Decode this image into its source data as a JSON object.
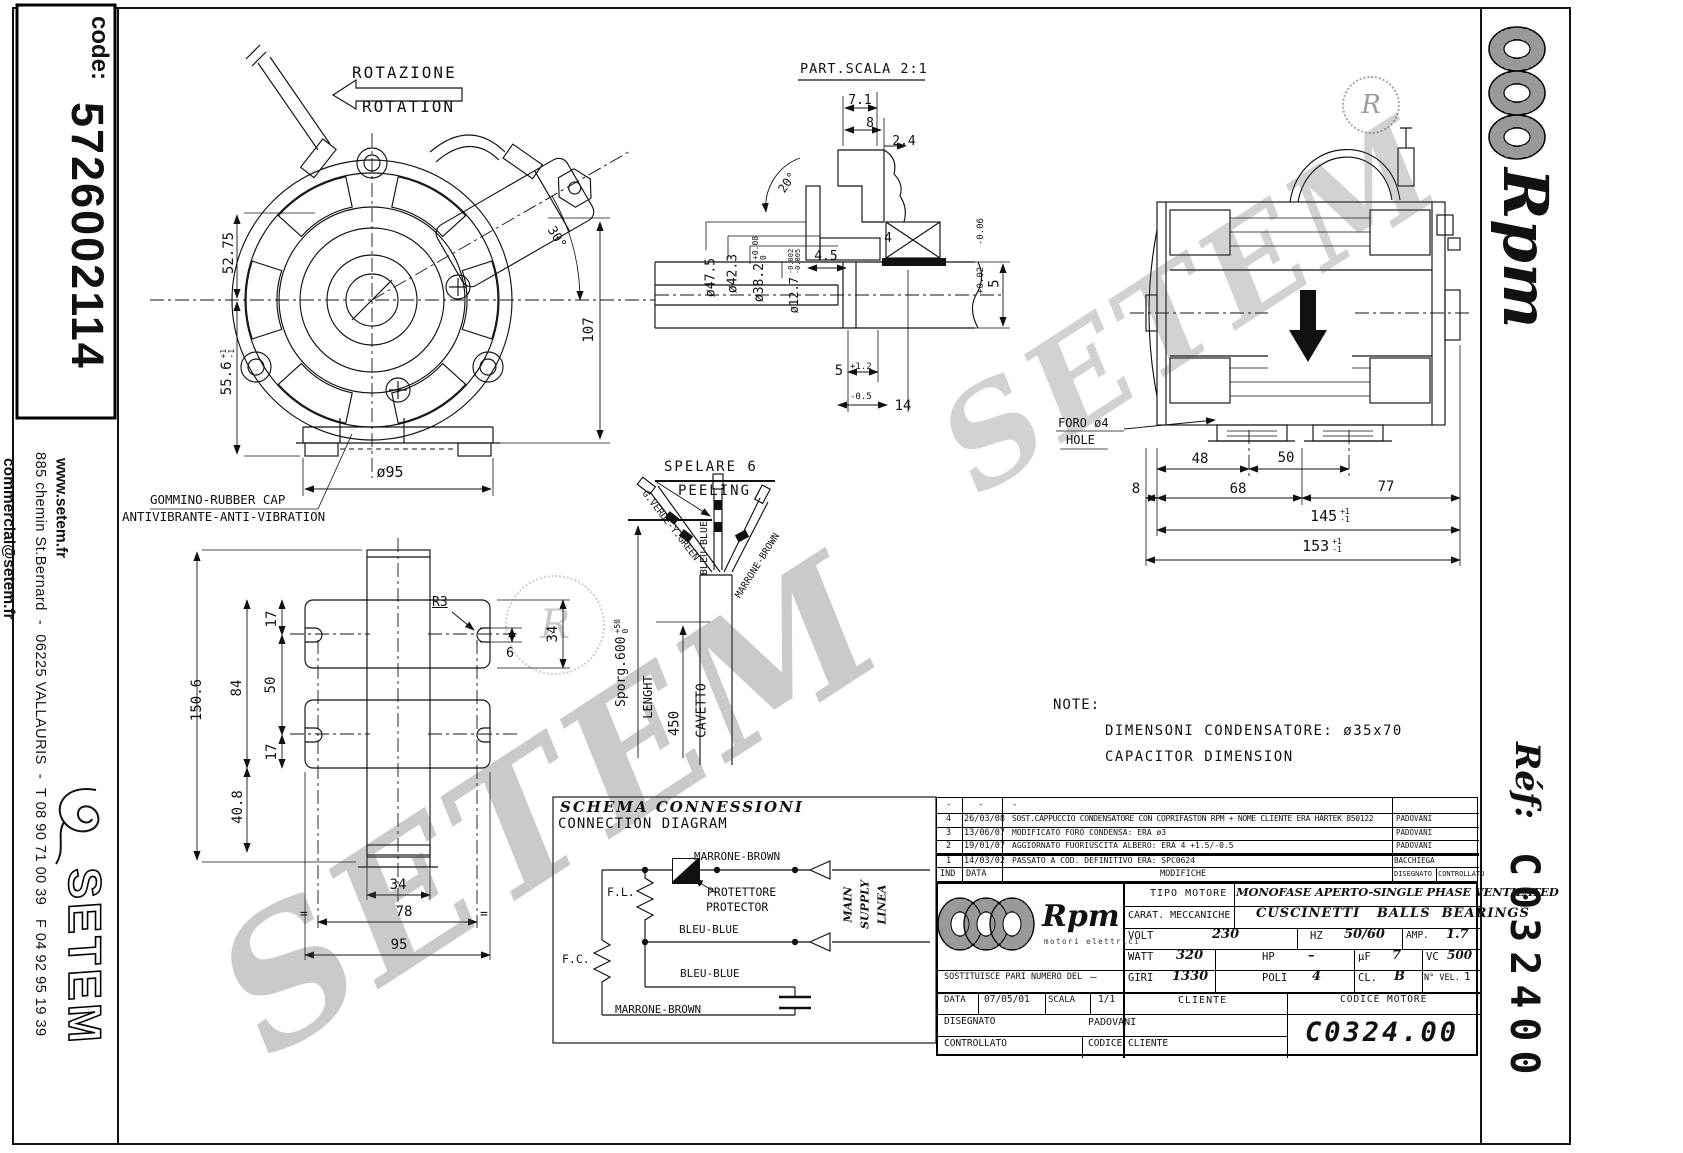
{
  "left_panel": {
    "code_label": "code:",
    "code_value": "5726002114",
    "address": "885 chemin St.Bernard  -  06225 VALLAURIS  -  T 08 90 71 00 39   F 04 92 95 19 39",
    "website": "www.setem.fr",
    "email": "commercial@setem.fr",
    "brand": "SETEM"
  },
  "right_panel": {
    "brand": "Rpm",
    "ref_label": "Réf:",
    "ref_value": "C032400"
  },
  "watermark": {
    "text": "SETEM",
    "mark": "R"
  },
  "rotation": {
    "it": "ROTAZIONE",
    "en": "ROTATION"
  },
  "front_view": {
    "dim_a": "52.75",
    "dim_b": "55.6",
    "dim_b_tp": "+1",
    "dim_b_tm": "-1",
    "dim_c": "107",
    "angle": "30°",
    "dim_d": "ø95",
    "cap_label_1": "GOMMINO-RUBBER CAP",
    "cap_label_2": "ANTIVIBRANTE-ANTI-VIBRATION"
  },
  "detail_view": {
    "title": "PART.SCALA 2:1",
    "d_71": "7.1",
    "d_8": "8",
    "d_24": "2.4",
    "angle": "20°",
    "dia_475": "ø47.5",
    "dia_423": "ø42.3",
    "dia_382": "ø38.2",
    "dia_382_tp": "+0.08",
    "dia_382_tm": "0",
    "dia_127": "ø12.7",
    "dia_127_tp": "-0.002",
    "dia_127_tm": "-0.005",
    "d_45": "4.5",
    "d_4": "4",
    "d_5": "5",
    "d_5_tp": "+1.2",
    "d_5_tm": "-0.5",
    "d_14": "14",
    "d_5r": "5",
    "d_5r_tp": "+0.02",
    "d_5r_tm": "-0.06"
  },
  "side_view": {
    "hole_it": "FORO ø4",
    "hole_en": "HOLE",
    "d_48": "48",
    "d_50": "50",
    "d_8": "8",
    "d_68": "68",
    "d_77": "77",
    "d_145": "145",
    "d_153": "153",
    "tol_p": "+1",
    "tol_m": "-1"
  },
  "bracket_view": {
    "d_1506": "150.6",
    "d_84": "84",
    "d_50": "50",
    "d_17a": "17",
    "d_17b": "17",
    "d_408": "40.8",
    "r3": "R3",
    "d_6": "6",
    "d_34r": "34",
    "d_34": "34",
    "d_78": "78",
    "d_95": "95",
    "eq": "="
  },
  "cable_view": {
    "title_it": "SPELARE 6",
    "title_en": "PEELING",
    "wire_green": "G.VERDE-Y.GREEN",
    "wire_blue": "BLEU-BLUE",
    "wire_brown": "MARRONE-BROWN",
    "sporg": "Sporg.600",
    "sporg_tp": "+50",
    "sporg_tm": "0",
    "lenght": "LENGHT",
    "d_450": "450",
    "cavetto": "CAVETTO"
  },
  "note": {
    "title": "NOTE:",
    "line1": "DIMENSONI CONDENSATORE: ø35x70",
    "line2": "CAPACITOR DIMENSION"
  },
  "diagram": {
    "title_it": "SCHEMA CONNESSIONI",
    "title_en": "CONNECTION DIAGRAM",
    "brown_top": "MARRONE-BROWN",
    "protector_it": "PROTETTORE",
    "protector_en": "PROTECTOR",
    "fl": "F.L.",
    "fc": "F.C.",
    "blue1": "BLEU-BLUE",
    "blue2": "BLEU-BLUE",
    "brown_bottom": "MARRONE-BROWN",
    "supply1": "MAIN",
    "supply2": "SUPPLY",
    "supply3": "LINEA"
  },
  "revisions": {
    "rows": [
      {
        "ind": "-",
        "data": "-",
        "mod": "-",
        "by": ""
      },
      {
        "ind": "4",
        "data": "26/03/08",
        "mod": "SOST.CAPPUCCIO CONDENSATORE CON COPRIFASTON RPM + NOME CLIENTE ERA HARTEK 850122",
        "by": "PADOVANI"
      },
      {
        "ind": "3",
        "data": "13/06/07",
        "mod": "MODIFICATO FORO CONDENSA: ERA ø3",
        "by": "PADOVANI"
      },
      {
        "ind": "2",
        "data": "19/01/07",
        "mod": "AGGIORNATO FUORIUSCITA ALBERO: ERA 4 +1.5/-0.5",
        "by": "PADOVANI"
      },
      {
        "ind": "1",
        "data": "14/03/02",
        "mod": "PASSATO A COD. DEFINITIVO ERA: SPC0624",
        "by": "BACCHIEGA"
      }
    ],
    "h_ind": "IND",
    "h_data": "DATA",
    "h_mod": "MODIFICHE",
    "h_dis": "DISEGNATO",
    "h_con": "CONTROLLATO"
  },
  "tblock": {
    "brand": "Rpm",
    "brand_sub": "motori elettrici",
    "tipo_l": "TIPO MOTORE",
    "tipo_v": "MONOFASE APERTO-SINGLE PHASE VENTILATED",
    "carat_l": "CARAT. MECCANICHE",
    "carat_v": "CUSCINETTI   BALLS  BEARINGS",
    "volt_l": "VOLT",
    "volt_v": "230",
    "hz_l": "HZ",
    "hz_v": "50/60",
    "amp_l": "AMP.",
    "amp_v": "1.7",
    "watt_l": "WATT",
    "watt_v": "320",
    "hp_l": "HP",
    "hp_v": "–",
    "uf_l": "µF",
    "uf_v": "7",
    "vc_l": "VC",
    "vc_v": "500",
    "sost_l": "SOSTITUISCE PARI NUMERO DEL",
    "sost_v": "–",
    "giri_l": "GIRI",
    "giri_v": "1330",
    "poli_l": "POLI",
    "poli_v": "4",
    "cl_l": "CL.",
    "cl_v": "B",
    "nvel_l": "N° VEL.",
    "nvel_v": "1",
    "data_l": "DATA",
    "data_v": "07/05/01",
    "scala_l": "SCALA",
    "scala_v": "1/1",
    "cliente_l": "CLIENTE",
    "cod_mot_l": "CODICE MOTORE",
    "cod_mot_v": "C0324.00",
    "dis_l": "DISEGNATO",
    "dis_v": "PADOVANI",
    "con_l": "CONTROLLATO",
    "cod_cli_l": "CODICE CLIENTE"
  }
}
